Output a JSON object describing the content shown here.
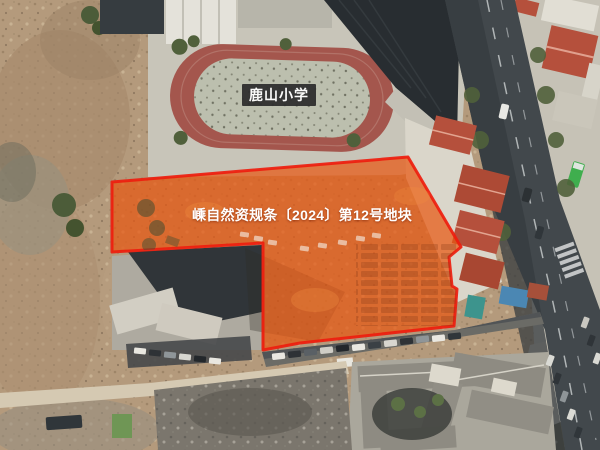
{
  "view": {
    "parcel_label": "嵊自然资规条〔2024〕第12号地块",
    "school_label": "鹿山小学",
    "colors": {
      "parcel_fill": "#E75812",
      "parcel_border": "#EE1D0E",
      "label_text": "#FFFFFF",
      "school_label_bg": "#2E2E2E",
      "track_ring": "#A4564D",
      "track_infield": "#BCBFAE",
      "road_asphalt": "#42484C",
      "red_roof": "#B5503C",
      "dirt_base": "#B49A7C",
      "vegetation": "#50603B"
    }
  }
}
